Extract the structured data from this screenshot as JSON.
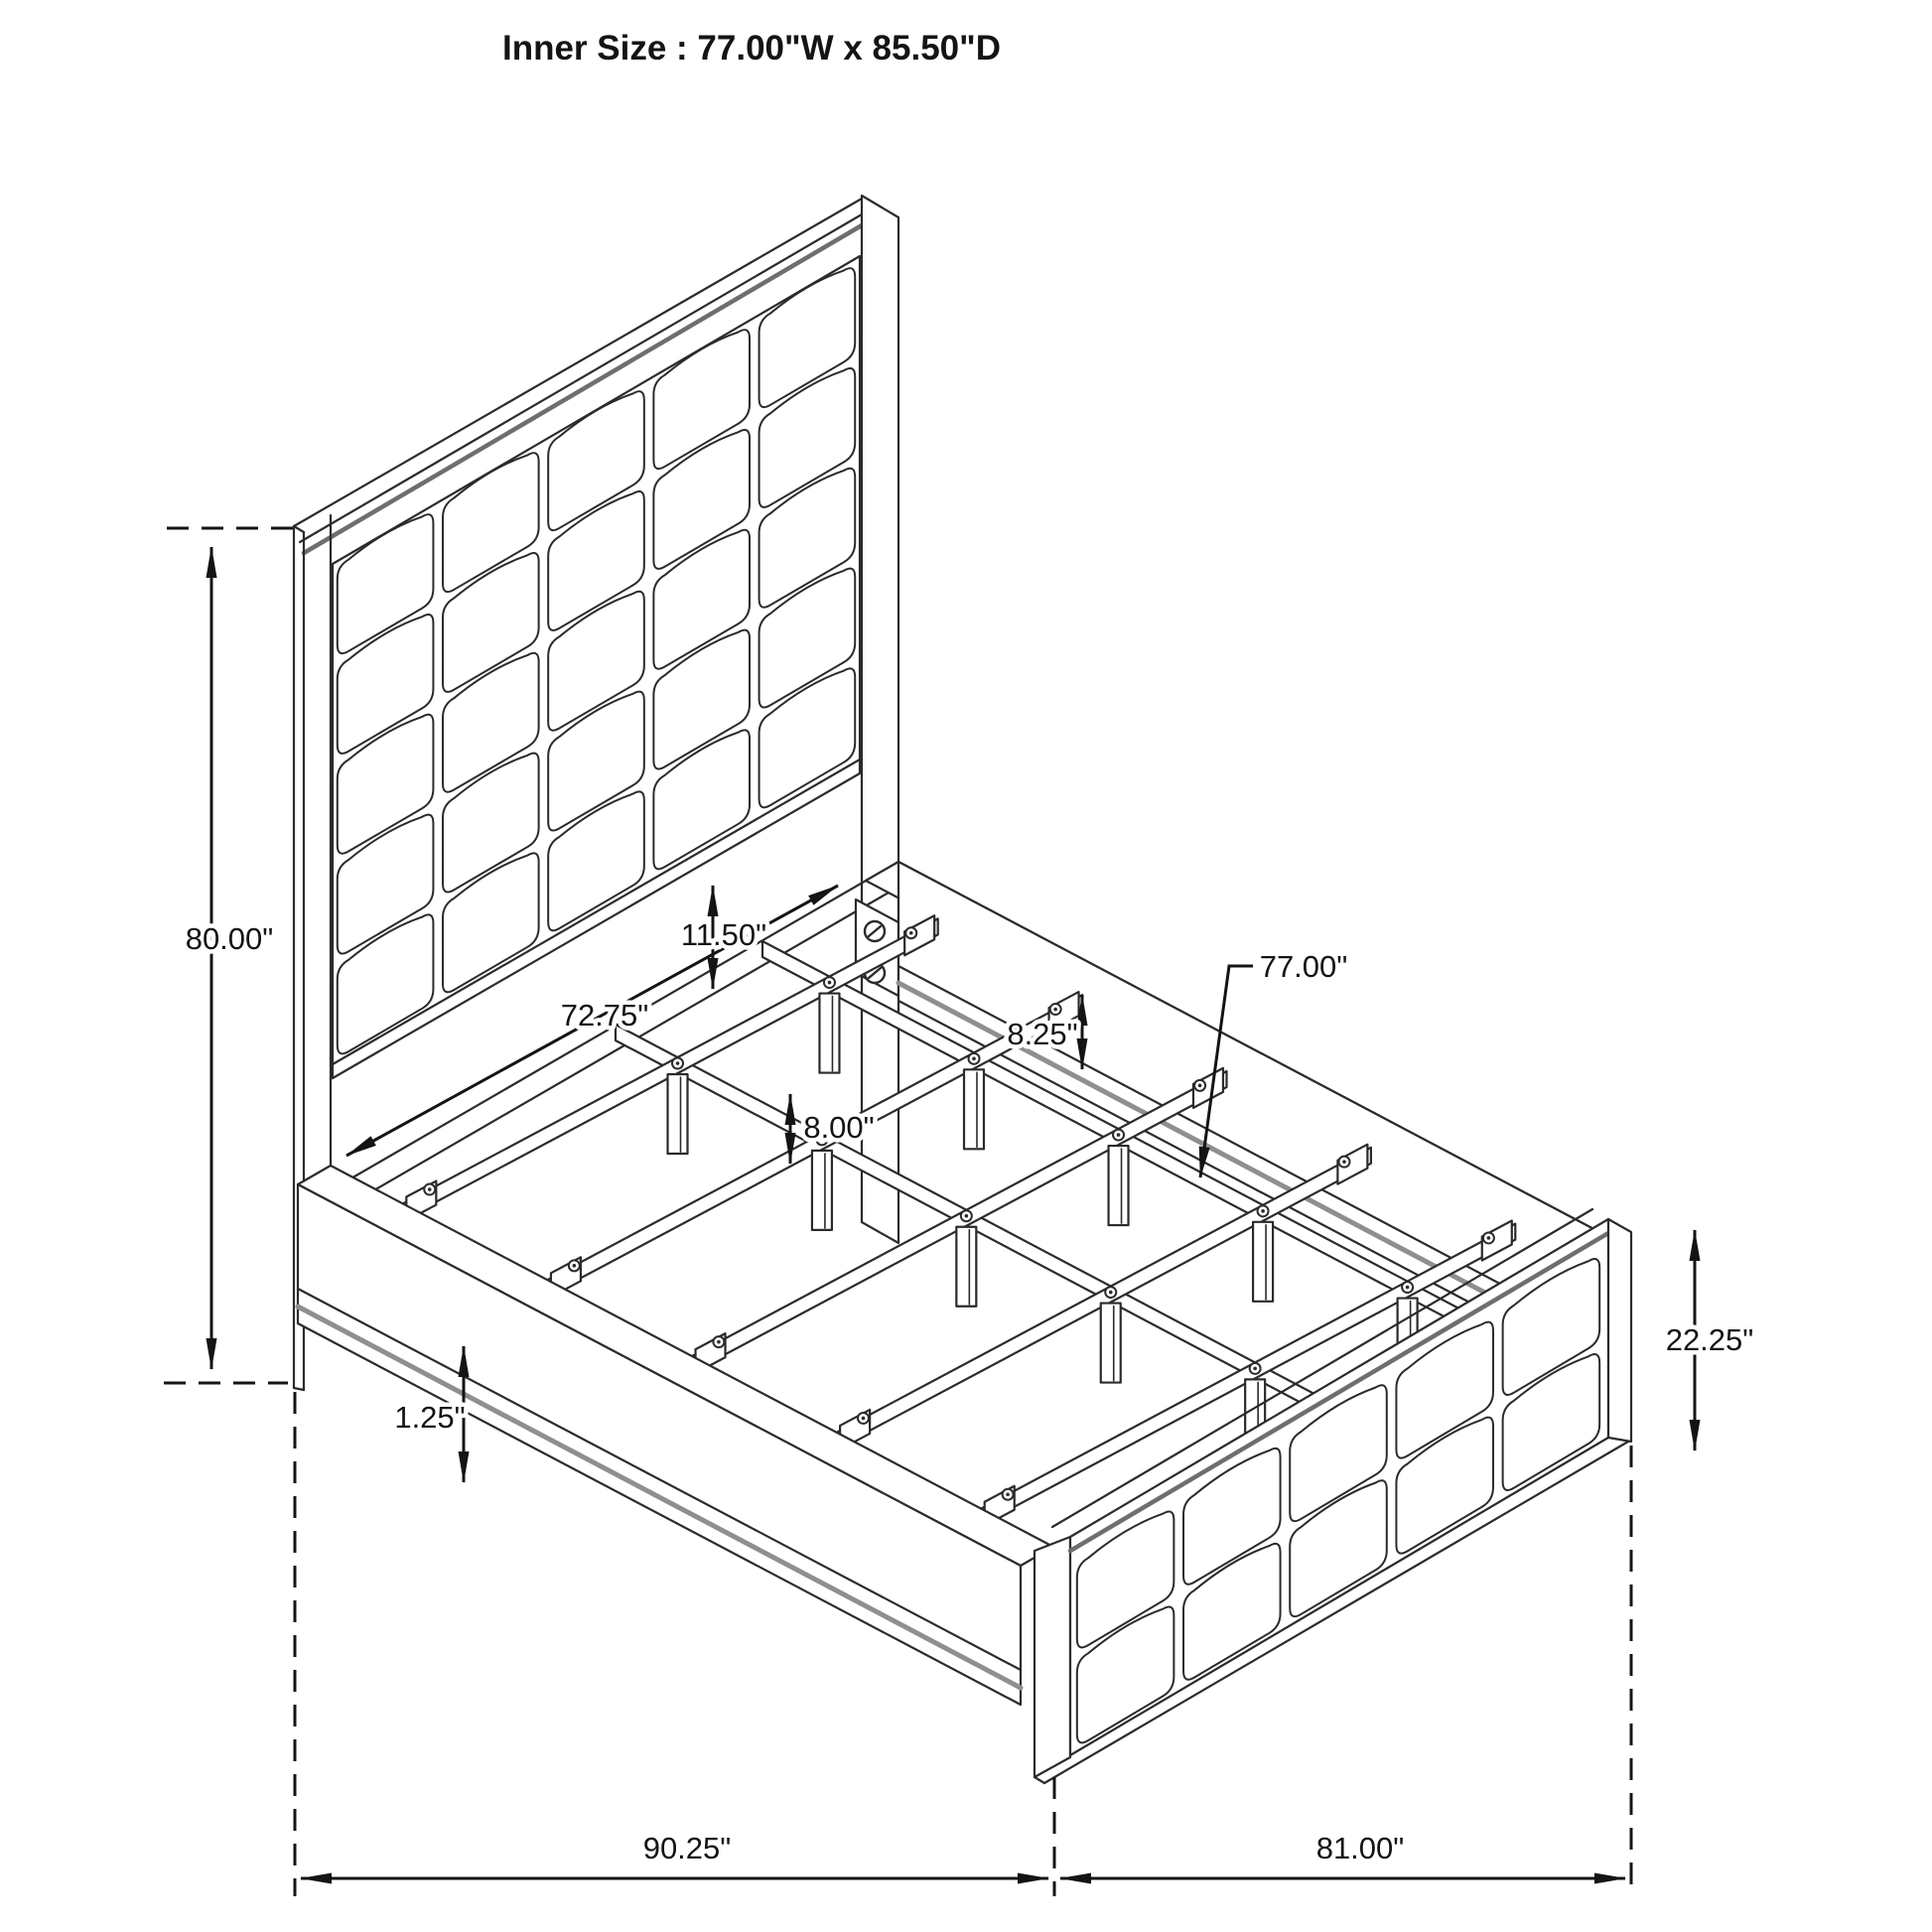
{
  "title": "Inner Size : 77.00\"W x 85.50\"D",
  "colors": {
    "ink": "#2b2b2b",
    "muted": "#8f8f8f",
    "trim": "#6e6e6e",
    "dim_ink": "#141414",
    "paper": "#ffffff"
  },
  "diagram": {
    "type": "isometric-furniture-dimension-drawing",
    "subject": "panel bed frame with tufted headboard and footboard, slat support system",
    "headboard_grid": {
      "cols": 5,
      "rows": 5
    },
    "footboard_grid": {
      "cols": 5,
      "rows": 2
    },
    "slat_count": 5,
    "support_rail_count": 2,
    "labels": {
      "headboard_height": "80.00\"",
      "headboard_clearance": "11.50\"",
      "inner_post_width": "72.75\"",
      "rail_drop": "8.25\"",
      "slat_width": "77.00\"",
      "leg_height": "8.00\"",
      "base_height": "1.25\"",
      "footboard_height": "22.25\"",
      "overall_depth": "90.25\"",
      "overall_width": "81.00\""
    }
  }
}
